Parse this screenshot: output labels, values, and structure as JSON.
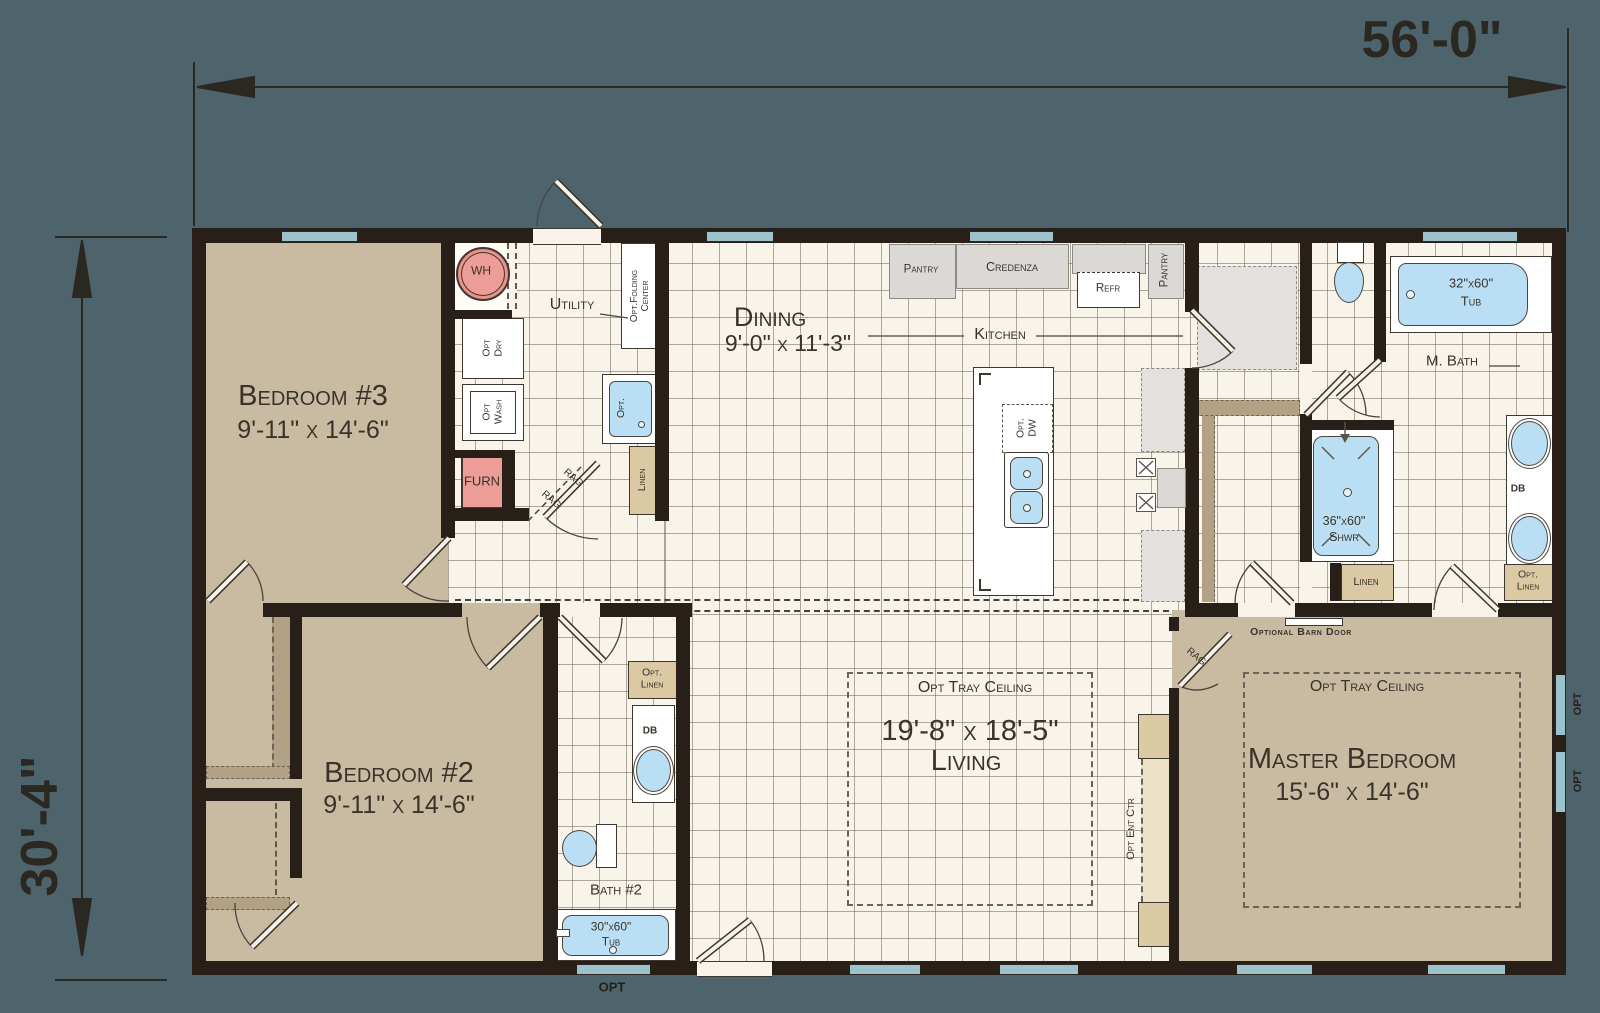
{
  "dimensions": {
    "width": "56'-0\"",
    "height": "30'-4\""
  },
  "rooms": {
    "bedroom3": {
      "name": "Bedroom #3",
      "size": "9'-11\" x 14'-6\""
    },
    "bedroom2": {
      "name": "Bedroom #2",
      "size": "9'-11\" x 14'-6\""
    },
    "master": {
      "name": "Master Bedroom",
      "size": "15'-6\" x 14'-6\""
    },
    "dining": {
      "name": "Dining",
      "size": "9'-0\" x 11'-3\""
    },
    "living": {
      "name": "Living",
      "size": "19'-8\" x 18'-5\""
    },
    "kitchen": {
      "name": "Kitchen"
    },
    "utility": {
      "name": "Utility"
    },
    "mbath": {
      "name": "M. Bath"
    },
    "bath2": {
      "name": "Bath #2"
    }
  },
  "features": {
    "water_heater": "WH",
    "furnace": "FURN",
    "opt_dry_1": "Opt",
    "opt_dry_2": "Dry",
    "opt_wash_1": "Opt",
    "opt_wash_2": "Wash",
    "folding_1": "Opt.Folding",
    "folding_2": "Center",
    "opt_sink": "Opt.",
    "linen_utility": "Linen",
    "rag_upper": "RAG",
    "rag_lower": "RAG",
    "rag_master": "RAG",
    "pantry_cabinet": "Pantry",
    "credenza": "Credenza",
    "refrigerator": "Refr",
    "pantry_tall": "Pantry",
    "opt_dw_1": "Opt.",
    "opt_dw_2": "DW",
    "master_tub_size": "32\"x60\"",
    "master_tub": "Tub",
    "shower_size": "36\"x60\"",
    "shower": "Shwr",
    "linen_mbath": "Linen",
    "db_mbath": "DB",
    "opt_linen_mbath_1": "Opt.",
    "opt_linen_mbath_2": "Linen",
    "barn_door": "Optional Barn Door",
    "tray_living": "Opt Tray Ceiling",
    "tray_master": "Opt Tray Ceiling",
    "ent_ctr": "Opt Ent Ctr",
    "opt_linen_bath2_1": "Opt.",
    "opt_linen_bath2_2": "Linen",
    "db_bath2": "DB",
    "bath2_tub_size": "30\"x60\"",
    "bath2_tub": "Tub",
    "opt_window_bottom": "OPT",
    "opt_window_right_1": "OPT",
    "opt_window_right_2": "OPT"
  },
  "colors": {
    "background": "#4e646d",
    "walls": "#271f18",
    "tile_floor": "#f8f4e9",
    "carpet_floor": "#c9baa2",
    "fixture_blue": "#badef3",
    "mechanical_pink": "#ec9d97",
    "cabinet_tan": "#dbc9a4",
    "appliance_gray": "#dbd9d6",
    "window_teal": "#9cc2cb"
  }
}
